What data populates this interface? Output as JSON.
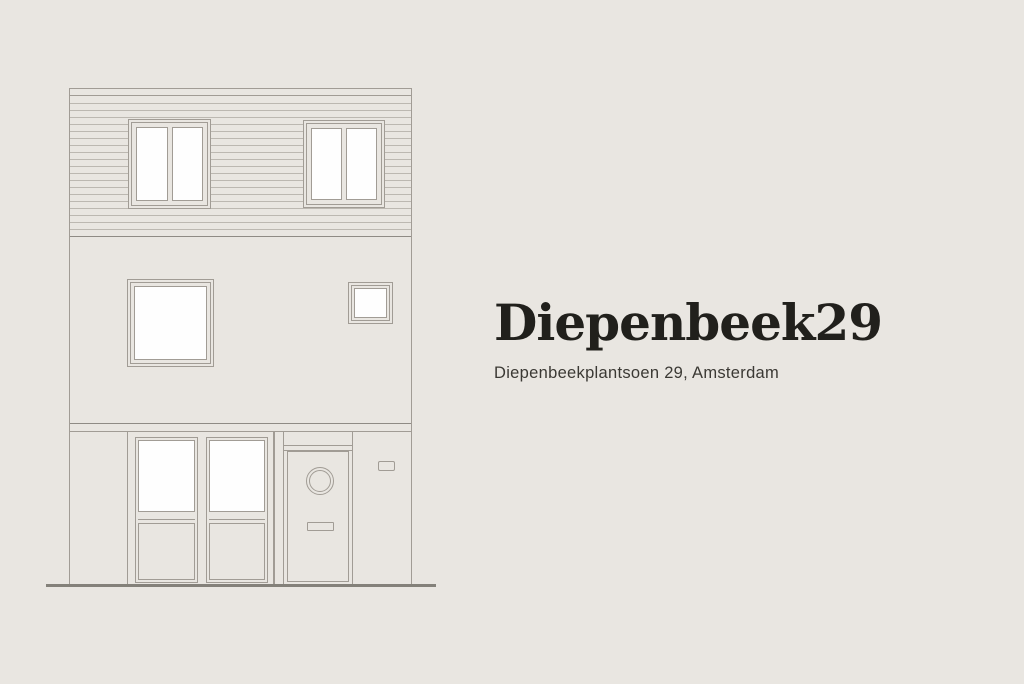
{
  "theme": {
    "bg": "#e9e6e1",
    "line": "#a19c95",
    "line-soft": "#bcb8b1",
    "line-dark": "#8f8b85",
    "ground": "#84817a",
    "glass": "#fefefe",
    "title-color": "#21201c",
    "subtitle-color": "#3b3934"
  },
  "hero": {
    "title": "Diepenbeek29",
    "subtitle": "Diepenbeekplantsoen 29, Amsterdam"
  },
  "illustration": {
    "type": "house-facade-elevation-line-drawing",
    "floors": 3,
    "features": [
      "siding-top-floor",
      "two-double-pane-windows-top",
      "large-square-window-middle",
      "small-square-window-middle",
      "storefront-windows-ground",
      "front-door-with-porthole-and-letterbox",
      "wall-plaque",
      "ground-line"
    ]
  }
}
